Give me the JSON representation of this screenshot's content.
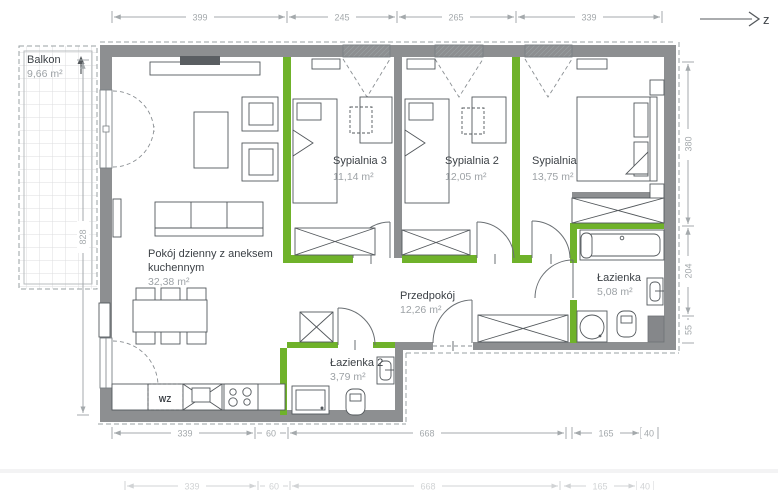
{
  "compass": {
    "label": "z"
  },
  "balcony": {
    "name": "Balkon",
    "area": "9,66 m²"
  },
  "rooms": {
    "living": {
      "name_line1": "Pokój dzienny z aneksem",
      "name_line2": "kuchennym",
      "area": "32,38 m²"
    },
    "bedroom3": {
      "name": "Sypialnia 3",
      "area": "11,14 m²"
    },
    "bedroom2": {
      "name": "Sypialnia 2",
      "area": "12,05 m²"
    },
    "bedroom1": {
      "name": "Sypialnia",
      "area": "13,75 m²"
    },
    "bathroom": {
      "name": "Łazienka",
      "area": "5,08 m²"
    },
    "hall": {
      "name": "Przedpokój",
      "area": "12,26 m²"
    },
    "bathroom2": {
      "name": "Łazienka 2",
      "area": "3,79 m²"
    }
  },
  "kitchen": {
    "cabinet_label": "WZ"
  },
  "dims": {
    "top": [
      "399",
      "245",
      "265",
      "339"
    ],
    "bottom": [
      "339",
      "60",
      "668",
      "165",
      "40"
    ],
    "bottom_faded": [
      "339",
      "60",
      "668",
      "165",
      "40"
    ],
    "left": [
      "828"
    ],
    "right": [
      "380",
      "204",
      "55"
    ]
  },
  "colors": {
    "wall": "#8d8f91",
    "accent_green": "#6fb22a",
    "dim_gray": "#a4a9ac",
    "room_text": "#3c4146",
    "area_text": "#9da2a6"
  }
}
